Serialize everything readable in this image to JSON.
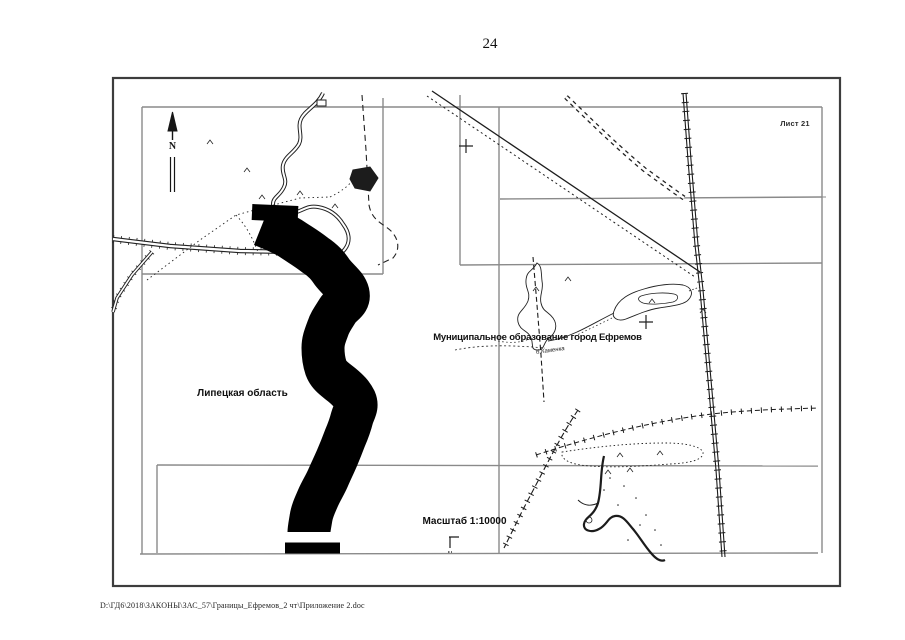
{
  "page": {
    "number": "24",
    "footer_path": "D:\\ГД6\\2018\\ЗАКОНЫ\\ЗАС_57\\Границы_Ефремов_2 чт\\Приложение 2.doc"
  },
  "map": {
    "sheet_label": "Лист 21",
    "municipality_label": "Муниципальное образование город Ефремов",
    "region_label": "Липецкая область",
    "scale_label": "Масштаб 1:10000",
    "stream_label": "б.Каменка",
    "north_label": "N",
    "colors": {
      "paper": "#ffffff",
      "ink": "#1c1c1c",
      "sheet_frame": "#8a8a8a",
      "outer_border": "#3d3d3d",
      "boundary_band": "#000000"
    }
  }
}
